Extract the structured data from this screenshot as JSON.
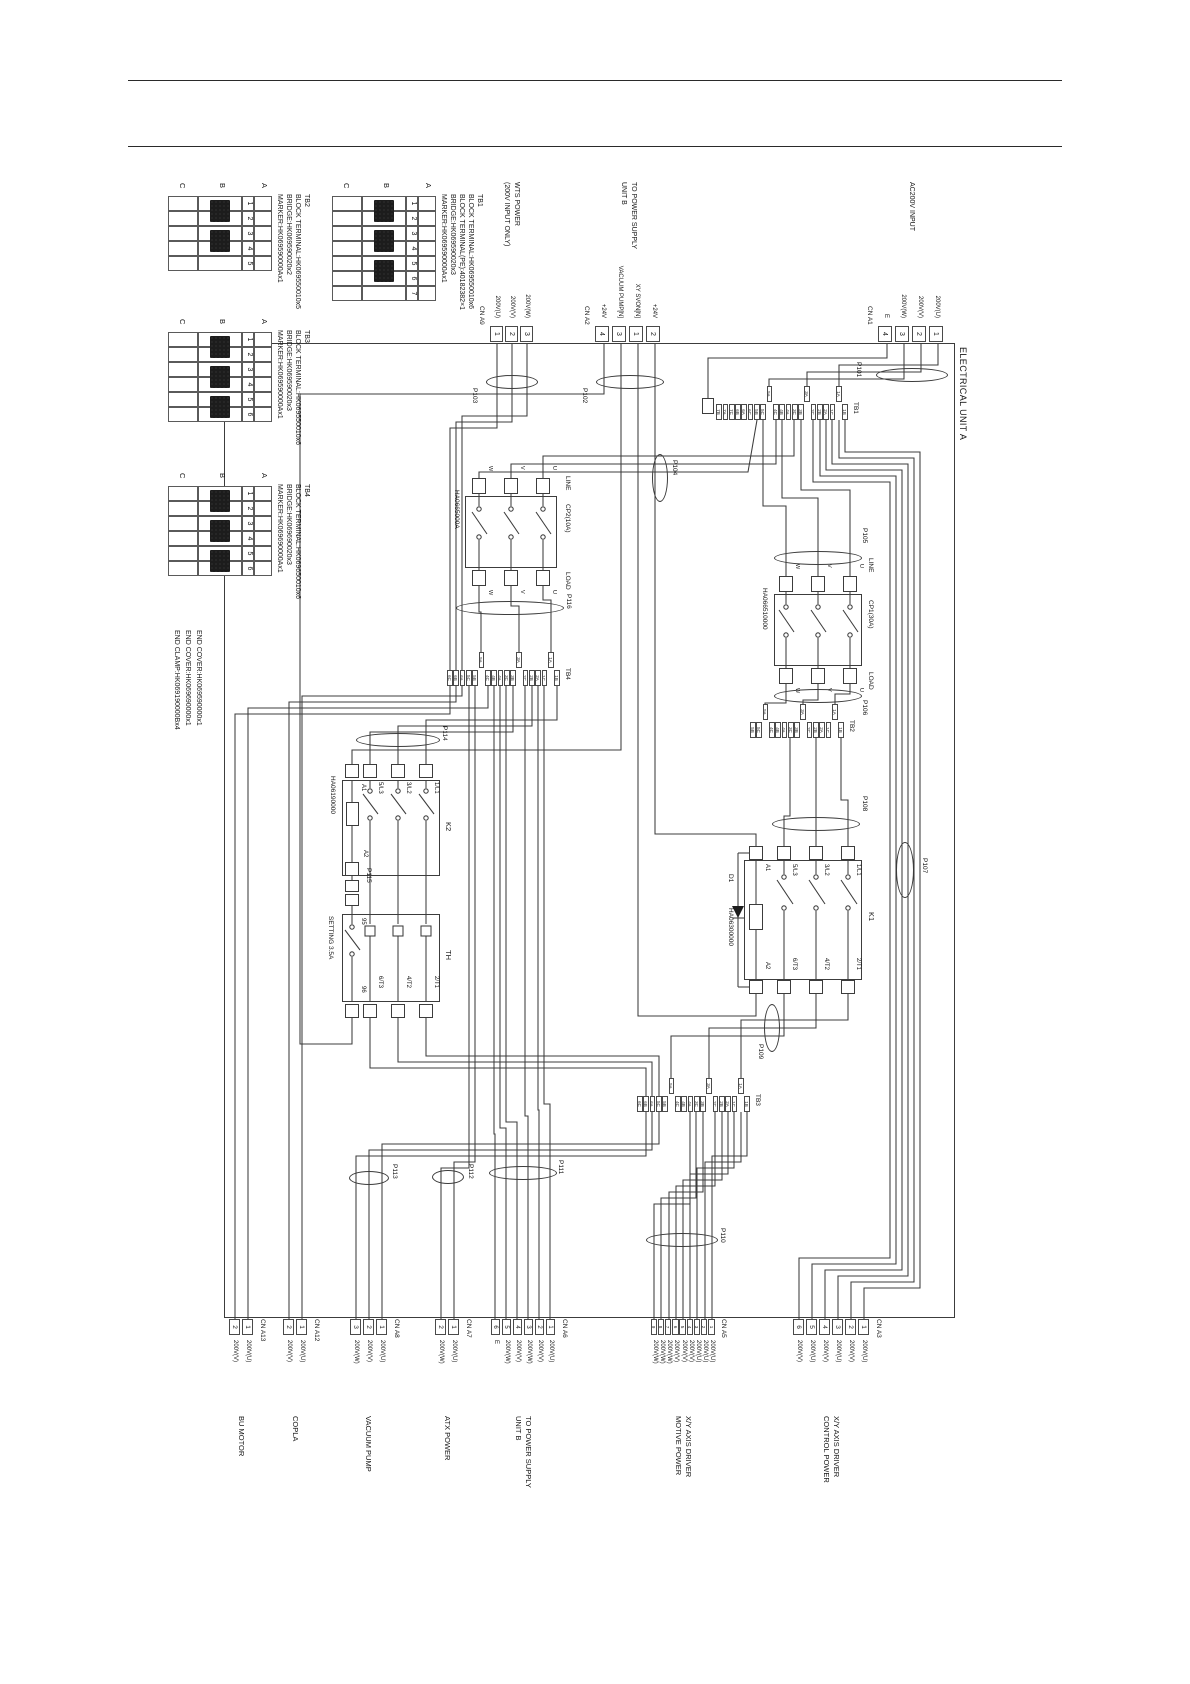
{
  "frame_label": "ELECTRICAL UNIT A",
  "part_tables": [
    {
      "id": "tb1",
      "name": "TB1",
      "lines": [
        "BLOCK TERMINAL:HK069550010x6",
        "BLOCK TERMINAL(PE):40182382×1",
        "BRIDGE:HK069590020x3",
        "MARKER:HK069590000Ax1"
      ],
      "terminals": [
        "1",
        "2",
        "3",
        "4",
        "5",
        "6",
        "7"
      ],
      "bridges": [
        [
          1,
          2
        ],
        [
          3,
          4
        ],
        [
          5,
          6
        ]
      ],
      "row_letters": [
        "A",
        "B",
        "C"
      ]
    },
    {
      "id": "tb2",
      "name": "TB2",
      "lines": [
        "BLOCK TERMINAL:HK069550010x5",
        "BRIDGE:HK069590020x2",
        "MARKER:HK069590000Ax1"
      ],
      "terminals": [
        "1",
        "2",
        "3",
        "4",
        "5"
      ],
      "bridges": [
        [
          1,
          2
        ],
        [
          3,
          4
        ]
      ],
      "row_letters": [
        "A",
        "B",
        "C"
      ]
    },
    {
      "id": "tb3",
      "name": "TB3",
      "lines": [
        "BLOCK TERMINAL:HK069550010x6",
        "BRIDGE:HK069590020x3",
        "MARKER:HK069590000Ax1"
      ],
      "terminals": [
        "1",
        "2",
        "3",
        "4",
        "5",
        "6"
      ],
      "bridges": [
        [
          1,
          2
        ],
        [
          3,
          4
        ],
        [
          5,
          6
        ]
      ],
      "row_letters": [
        "A",
        "B",
        "C"
      ]
    },
    {
      "id": "tb4",
      "name": "TB4",
      "lines": [
        "BLOCK TERMINAL:HK069650010x6",
        "BRIDGE:HK069690020x3",
        "MARKER:HK069690000Ax1"
      ],
      "terminals": [
        "1",
        "2",
        "3",
        "4",
        "5",
        "6"
      ],
      "bridges": [
        [
          1,
          2
        ],
        [
          3,
          4
        ],
        [
          5,
          6
        ]
      ],
      "row_letters": [
        "A",
        "B",
        "C"
      ]
    }
  ],
  "end_notes": [
    "END COVER:HK069590000x1",
    "END COVER:HK069690000x1",
    "END CLAMP:HK069190000Bx4"
  ],
  "tb_strips": [
    {
      "id": "tb1s",
      "name": "TB1",
      "raised": [
        "1A",
        "3A",
        "5A"
      ],
      "pins": [
        "1B",
        "1A",
        "1C",
        "2A",
        "2B",
        "2C",
        "3A",
        "3B",
        "3C",
        "4A",
        "4B",
        "4C",
        "5A",
        "5C",
        "5B",
        "6C",
        "6A",
        "6B",
        "7C",
        "7A",
        "7B"
      ]
    },
    {
      "id": "tb2s",
      "name": "TB2",
      "raised": [
        "1A",
        "3A",
        "5A"
      ],
      "pins": [
        "1B",
        "1A",
        "1C",
        "2A",
        "2B",
        "2C",
        "3A",
        "3B",
        "3C",
        "4A",
        "4B",
        "4C",
        "5A",
        "5C",
        "5B"
      ]
    },
    {
      "id": "tb3s",
      "name": "TB3",
      "raised": [
        "1A",
        "3A",
        "5A"
      ],
      "pins": [
        "1B",
        "1A",
        "1C",
        "2A",
        "2B",
        "2C",
        "3A",
        "3B",
        "3C",
        "4A",
        "4B",
        "4C",
        "5A",
        "5B",
        "5C",
        "6A",
        "6B",
        "6C"
      ]
    },
    {
      "id": "tb4s",
      "name": "TB4",
      "raised": [
        "1A",
        "3A",
        "5A"
      ],
      "pins": [
        "1B",
        "1A",
        "1C",
        "2A",
        "2B",
        "2C",
        "3A",
        "3B",
        "3C",
        "4A",
        "4B",
        "4C",
        "5A",
        "5B",
        "5C",
        "6A",
        "6B",
        "6C"
      ]
    }
  ],
  "connectors": [
    {
      "id": "a1",
      "name": "CN A1",
      "side": "left",
      "cable": "P101",
      "device": [
        "AC200V INPUT"
      ],
      "pins": [
        {
          "n": "1",
          "label": "200V(U)"
        },
        {
          "n": "2",
          "label": "200V(V)"
        },
        {
          "n": "3",
          "label": "200V(W)"
        },
        {
          "n": "4",
          "label": "E"
        }
      ]
    },
    {
      "id": "a2",
      "name": "CN A2",
      "side": "left",
      "cable": "P102",
      "device": [
        "TO POWER SUPPLY",
        "UNIT B"
      ],
      "pins": [
        {
          "n": "2",
          "label": "+24V"
        },
        {
          "n": "1",
          "label": "XY SVON[N]"
        },
        {
          "n": "3",
          "label": "VACUUM PUMP[N]"
        },
        {
          "n": "4",
          "label": "+24V"
        }
      ]
    },
    {
      "id": "a9",
      "name": "CN A9",
      "side": "left",
      "cable": "P103",
      "device": [
        "WTS POWER",
        "(200V INPUT ONLY)"
      ],
      "pins": [
        {
          "n": "3",
          "label": "200V(W)"
        },
        {
          "n": "2",
          "label": "200V(V)"
        },
        {
          "n": "1",
          "label": "200V(U)"
        }
      ]
    },
    {
      "id": "a3",
      "name": "CN A3",
      "side": "right",
      "device": [
        "X/Y AXIS DRIVER",
        "CONTROL POWER"
      ],
      "pins": [
        {
          "n": "1",
          "label": "200V(U)"
        },
        {
          "n": "2",
          "label": "200V(V)"
        },
        {
          "n": "3",
          "label": "200V(U)"
        },
        {
          "n": "4",
          "label": "200V(V)"
        },
        {
          "n": "5",
          "label": "200V(U)"
        },
        {
          "n": "6",
          "label": "200V(V)"
        }
      ]
    },
    {
      "id": "a5",
      "name": "CN A5",
      "side": "right",
      "cable": "P110",
      "device": [
        "X/Y AXIS DRIVER",
        "MOTIVE POWER"
      ],
      "pins": [
        {
          "n": "1",
          "label": "200V(U)"
        },
        {
          "n": "2",
          "label": "200V(U)"
        },
        {
          "n": "3",
          "label": "200V(U)"
        },
        {
          "n": "4",
          "label": "200V(V)"
        },
        {
          "n": "5",
          "label": "200V(V)"
        },
        {
          "n": "6",
          "label": "200V(V)"
        },
        {
          "n": "7",
          "label": "200V(W)"
        },
        {
          "n": "8",
          "label": "200V(W)"
        },
        {
          "n": "9",
          "label": "200V(W)"
        }
      ]
    },
    {
      "id": "a6",
      "name": "CN A6",
      "side": "right",
      "cable": "P111",
      "device": [
        "TO POWER SUPPLY",
        "UNIT B"
      ],
      "pins": [
        {
          "n": "1",
          "label": "200V(U)"
        },
        {
          "n": "2",
          "label": "200V(V)"
        },
        {
          "n": "3",
          "label": "200V(W)"
        },
        {
          "n": "4",
          "label": "200V(V)"
        },
        {
          "n": "5",
          "label": "200V(W)"
        },
        {
          "n": "6",
          "label": "E"
        }
      ]
    },
    {
      "id": "a7",
      "name": "CN A7",
      "side": "right",
      "cable": "P112",
      "device": [
        "ATX POWER"
      ],
      "pins": [
        {
          "n": "1",
          "label": "200V(U)"
        },
        {
          "n": "2",
          "label": "200V(W)"
        }
      ]
    },
    {
      "id": "a8",
      "name": "CN A8",
      "side": "right",
      "cable": "P113",
      "device": [
        "VACUUM PUMP"
      ],
      "pins": [
        {
          "n": "1",
          "label": "200V(U)"
        },
        {
          "n": "2",
          "label": "200V(V)"
        },
        {
          "n": "3",
          "label": "200V(W)"
        }
      ]
    },
    {
      "id": "a12",
      "name": "CN A12",
      "side": "right",
      "device": [
        "COPLA"
      ],
      "pins": [
        {
          "n": "1",
          "label": "200V(U)"
        },
        {
          "n": "2",
          "label": "200V(V)"
        }
      ]
    },
    {
      "id": "a13",
      "name": "CN A13",
      "side": "right",
      "device": [
        "BU MOTOR"
      ],
      "pins": [
        {
          "n": "1",
          "label": "200V(U)"
        },
        {
          "n": "2",
          "label": "200V(V)"
        }
      ]
    }
  ],
  "components": {
    "cp1": {
      "name": "CP1(30A)",
      "part": "HA066510000",
      "line_label": "LINE",
      "load_label": "LOAD",
      "poles": [
        "U",
        "V",
        "W"
      ]
    },
    "cp2": {
      "name": "CP2(10A)",
      "part": "HA0665000A",
      "line_label": "LINE",
      "load_label": "LOAD",
      "poles": [
        "U",
        "V",
        "W"
      ]
    },
    "k1": {
      "name": "K1",
      "part": "HA06300000",
      "diode": "D1",
      "line_terms": [
        "1/L1",
        "3/L2",
        "5/L3"
      ],
      "load_terms": [
        "2/T1",
        "4/T2",
        "6/T3"
      ],
      "coil_terms": [
        "A1",
        "A2"
      ]
    },
    "k2": {
      "name": "K2",
      "part": "HA06190000",
      "line_terms": [
        "1/L1",
        "3/L2",
        "5/L3"
      ],
      "load_terms": [
        "2/T1",
        "4/T2",
        "6/T3"
      ],
      "coil_terms": [
        "A1",
        "A2"
      ]
    },
    "th": {
      "name": "TH",
      "setting": "SETTING 3.5A",
      "aux_terms": [
        "95",
        "96"
      ],
      "load_terms": [
        "2/T1",
        "4/T2",
        "6/T3"
      ]
    },
    "p115": {
      "name": "P115"
    }
  },
  "cables": [
    "P101",
    "P102",
    "P103",
    "P104",
    "P105",
    "P106",
    "P107",
    "P108",
    "P109",
    "P110",
    "P111",
    "P112",
    "P113",
    "P114",
    "P116"
  ],
  "colors": {
    "line": "#3c3c3c",
    "text": "#151515",
    "bg": "#ffffff"
  }
}
